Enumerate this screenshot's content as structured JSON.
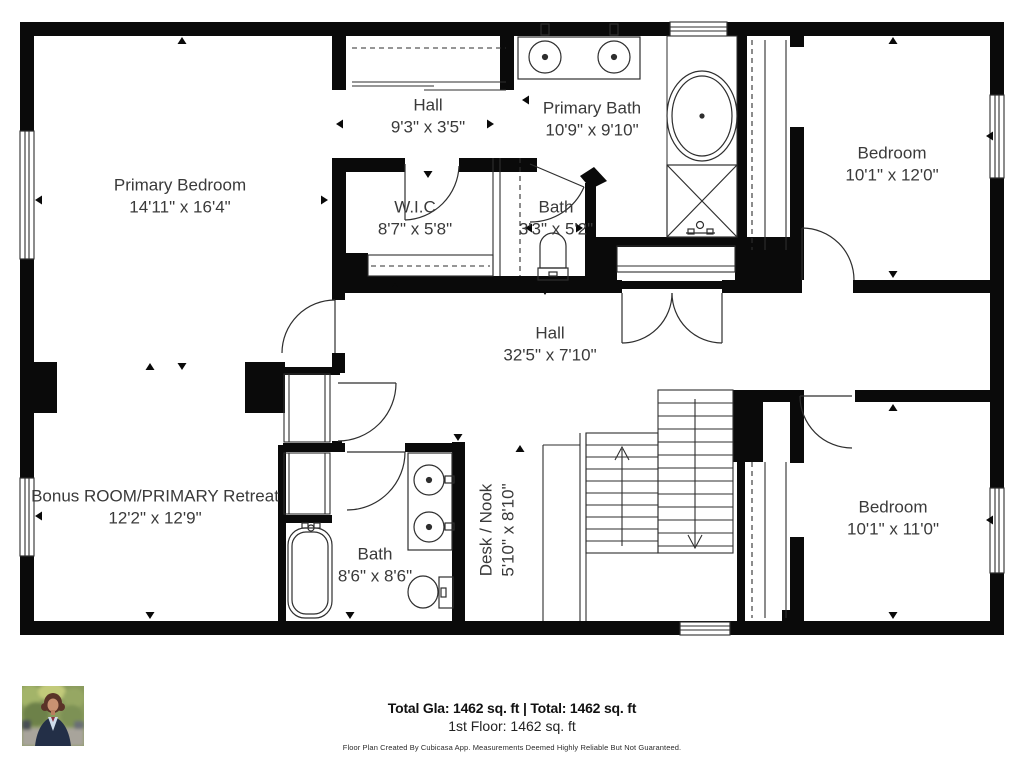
{
  "plan": {
    "rooms": [
      {
        "id": "primary-bedroom",
        "name": "Primary Bedroom",
        "dims": "14'11\" x 16'4\""
      },
      {
        "id": "hall-top",
        "name": "Hall",
        "dims": "9'3\" x 3'5\""
      },
      {
        "id": "primary-bath",
        "name": "Primary Bath",
        "dims": "10'9\" x 9'10\""
      },
      {
        "id": "bedroom-top-right",
        "name": "Bedroom",
        "dims": "10'1\" x 12'0\""
      },
      {
        "id": "walk-in-closet",
        "name": "W.I.C",
        "dims": "8'7\" x 5'8\""
      },
      {
        "id": "bath-small",
        "name": "Bath",
        "dims": "3'3\" x 5'2\""
      },
      {
        "id": "hall-main",
        "name": "Hall",
        "dims": "32'5\" x 7'10\""
      },
      {
        "id": "bonus-room",
        "name": "Bonus ROOM/PRIMARY Retreat",
        "dims": "12'2\" x 12'9\""
      },
      {
        "id": "bath-lower",
        "name": "Bath",
        "dims": "8'6\" x 8'6\""
      },
      {
        "id": "desk-nook",
        "name": "Desk / Nook",
        "dims": "5'10\" x 8'10\""
      },
      {
        "id": "bedroom-bottom-right",
        "name": "Bedroom",
        "dims": "10'1\" x 11'0\""
      }
    ],
    "footer": {
      "total_line": "Total Gla: 1462 sq. ft | Total: 1462 sq. ft",
      "floor_line": "1st Floor: 1462 sq. ft",
      "disclaimer": "Floor Plan Created By Cubicasa App. Measurements Deemed Highly Reliable But Not Guaranteed."
    },
    "colors": {
      "wall": "#0a0a0a",
      "line": "#2e2e2e",
      "background": "#ffffff"
    }
  }
}
